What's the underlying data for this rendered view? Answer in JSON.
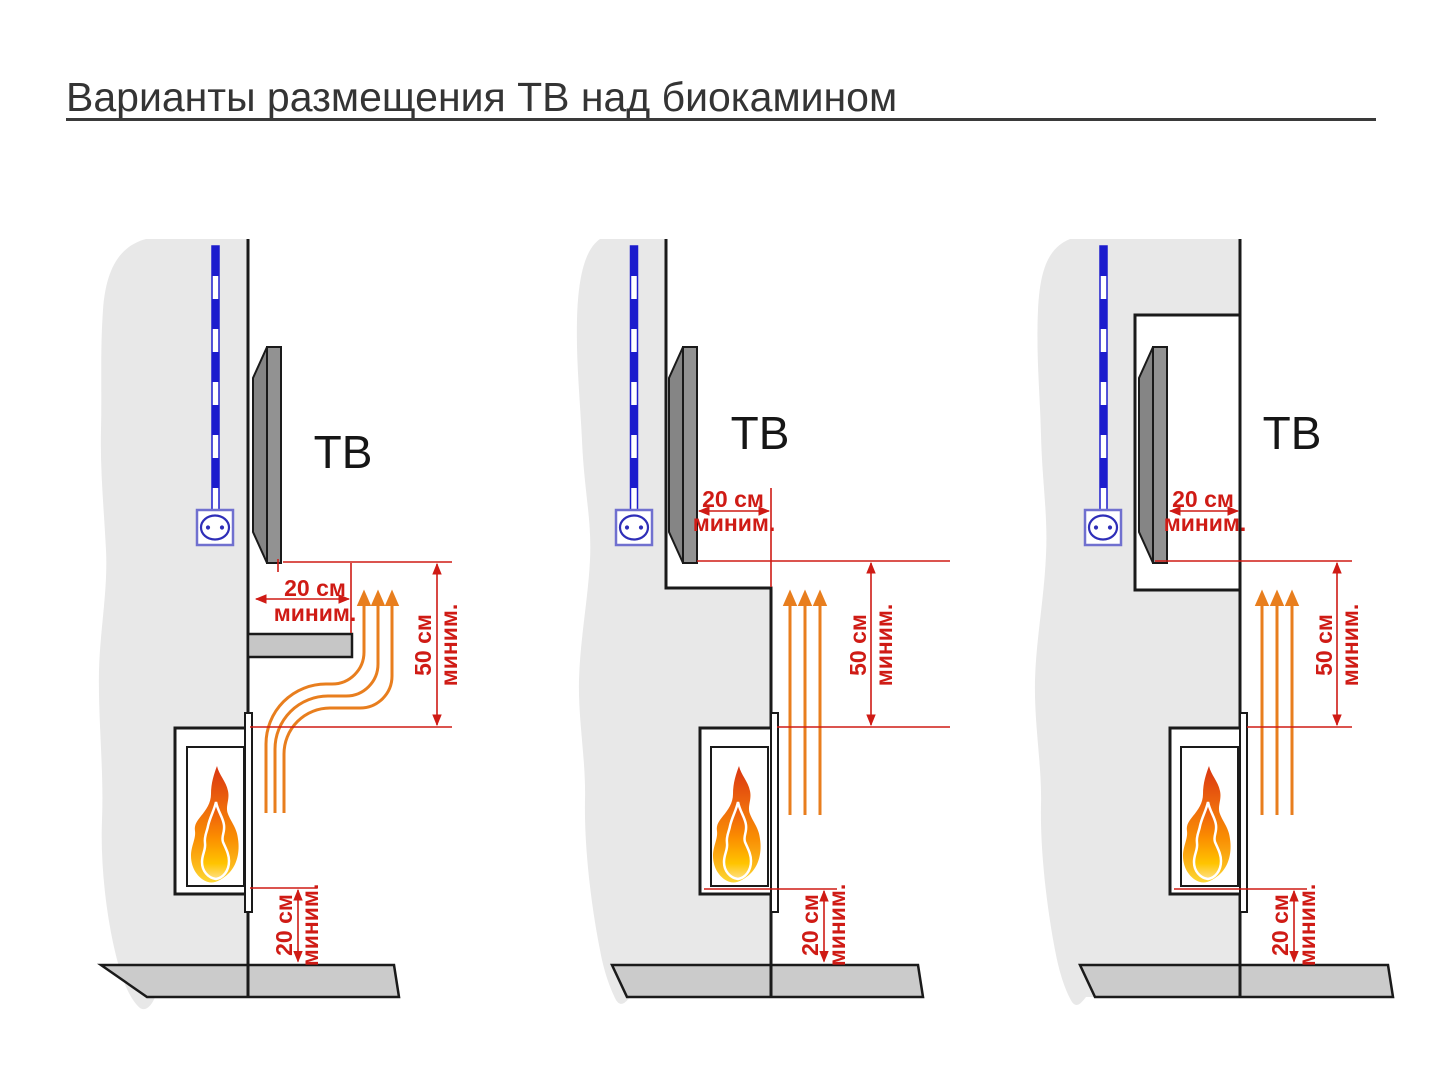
{
  "title": "Варианты размещения ТВ над биокамином",
  "diagrams": [
    {
      "id": "variant-shelf",
      "tv_label": "ТВ",
      "dim_top": {
        "value": "20 см",
        "note": "миним."
      },
      "dim_side": {
        "value": "50 см",
        "note": "миним."
      },
      "dim_bottom": {
        "value": "20 см",
        "note": "миним."
      }
    },
    {
      "id": "variant-wall-step",
      "tv_label": "ТВ",
      "dim_top": {
        "value": "20 см",
        "note": "миним."
      },
      "dim_side": {
        "value": "50 см",
        "note": "миним."
      },
      "dim_bottom": {
        "value": "20 см",
        "note": "миним."
      }
    },
    {
      "id": "variant-niche",
      "tv_label": "ТВ",
      "dim_top": {
        "value": "20 см",
        "note": "миним."
      },
      "dim_side": {
        "value": "50 см",
        "note": "миним."
      },
      "dim_bottom": {
        "value": "20 см",
        "note": "миним."
      }
    }
  ],
  "colors": {
    "dimension_red": "#cf1b15",
    "heat_flow_orange": "#e87e1e",
    "cable_blue": "#1c1ccd",
    "wall_gray": "#e8e8e8",
    "floor_gray": "#cbcbcb",
    "tv_gray": "#8f8f8f"
  },
  "icons": [
    "flame-icon",
    "power-outlet-icon",
    "heat-arrow-icon",
    "power-cable-icon"
  ]
}
